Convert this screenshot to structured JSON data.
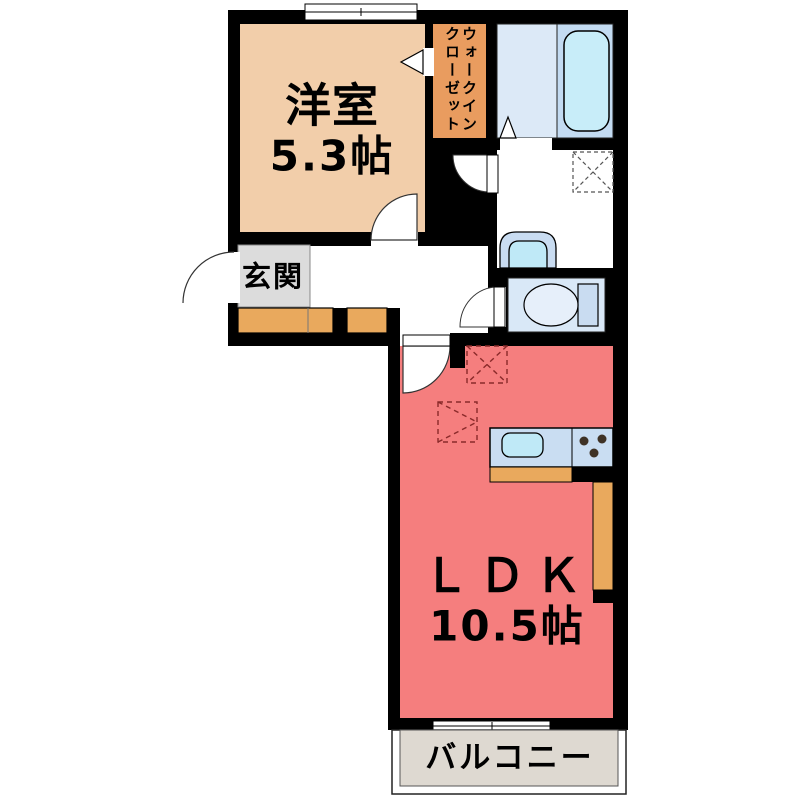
{
  "floorplan": {
    "western_room": {
      "label": "洋室",
      "area": "5.3帖"
    },
    "walk_in_closet": {
      "label_col1": "ウォークイン",
      "label_col2": "クローゼット"
    },
    "entrance": {
      "label": "玄関"
    },
    "ldk": {
      "label": "ＬＤＫ",
      "area": "10.5帖"
    },
    "balcony": {
      "label": "バルコニー"
    },
    "colors": {
      "wall": "#000000",
      "western_room_floor": "#F2CEAA",
      "closet_floor": "#E99C5F",
      "entrance_floor": "#DCDCDC",
      "cabinet_orange": "#E9A95D",
      "ldk_floor": "#F57E7E",
      "bath_floor": "#DCE9F7",
      "bath_tub_zone": "#C3DBF2",
      "bathtub": "#C8EDF9",
      "toilet_floor": "#D9E8F7",
      "fixture_blue": "#C9DCF1",
      "sink_cyan": "#BFE9F7",
      "counter_blue": "#C9DDF2",
      "burner_dark": "#3E3226",
      "balcony_floor": "#DED9D1"
    }
  }
}
